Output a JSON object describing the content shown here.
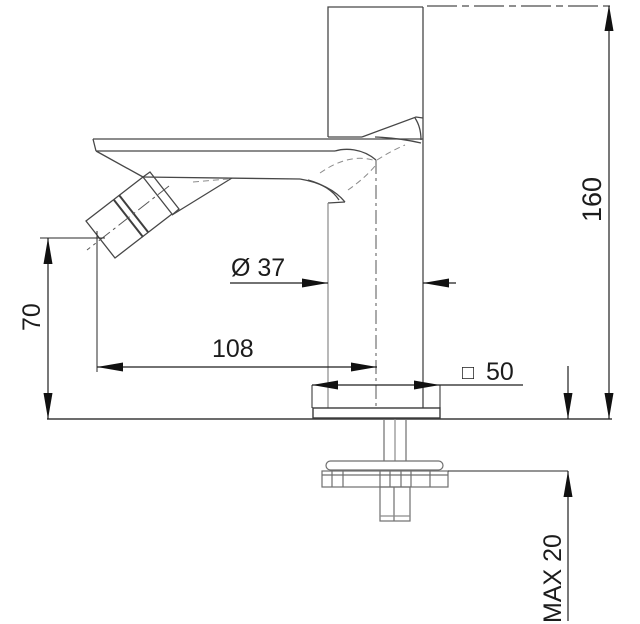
{
  "diagram": {
    "description": "Technical dimension drawing of a single-lever basin / bidet mixer tap, side view with mounting hardware below the deck",
    "dimensions": {
      "overall_height": "160",
      "spout_outlet_height": "70",
      "spout_reach": "108",
      "body_diameter": "Ø 37",
      "base_square_symbol": "□",
      "base_square_value": "50",
      "max_mounting_thickness": "MAX 20"
    },
    "colors": {
      "background": "#ffffff",
      "object_outline": "#474747",
      "dimension_line": "#1f1f1f"
    }
  }
}
